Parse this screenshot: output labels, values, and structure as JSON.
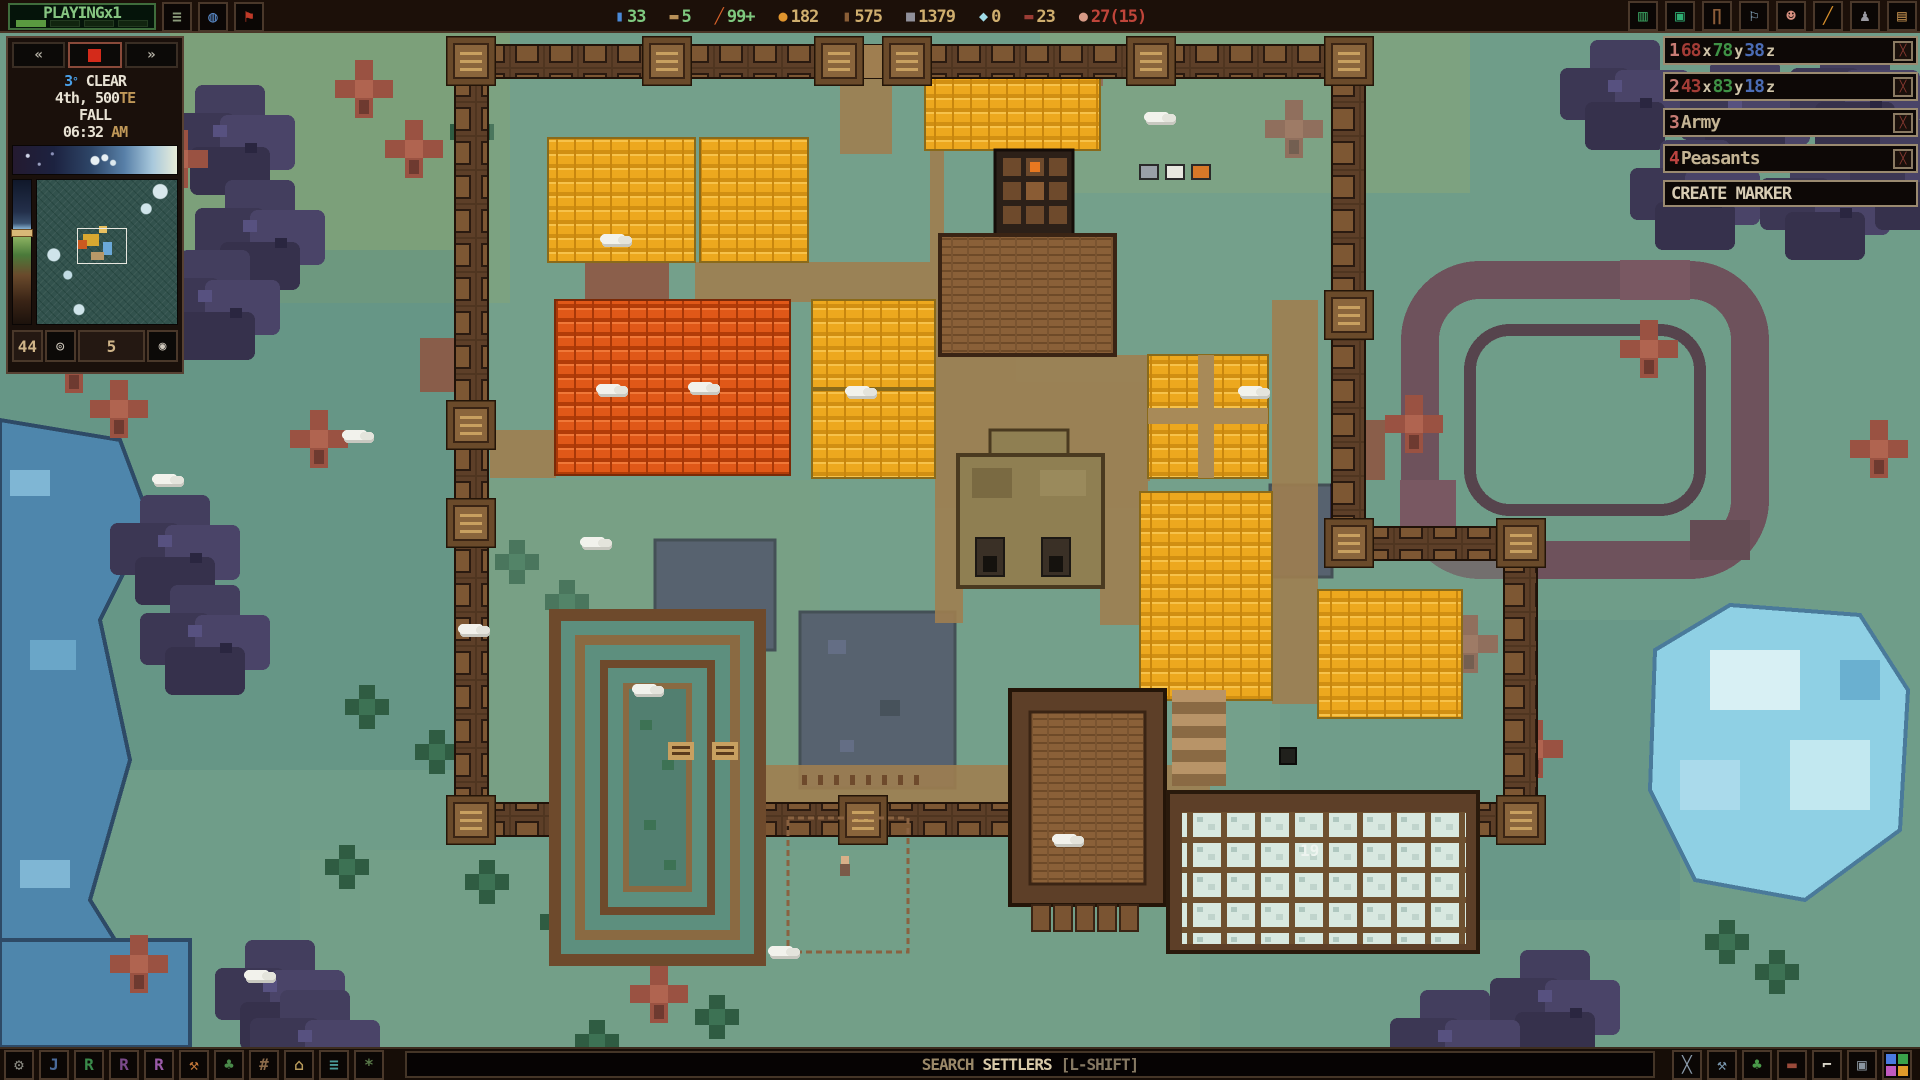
{
  "colors": {
    "accent_green": "#7fc97f",
    "accent_tan": "#cfae6e",
    "accent_red": "#c0453a",
    "ui_border": "#574133",
    "panel_bg": "#1a100b",
    "marker_border": "#9a8a70"
  },
  "top_bar": {
    "play_state": "PLAYINGx1",
    "progress_segments_total": 4,
    "progress_segments_filled": 1,
    "left_icons": [
      {
        "name": "menu-list-icon",
        "glyph": "≡",
        "color": "#8a9a7a"
      },
      {
        "name": "world-icon",
        "glyph": "◍",
        "color": "#5a8ac8"
      },
      {
        "name": "flag-icon",
        "glyph": "⚑",
        "color": "#c03a28"
      }
    ],
    "resources": [
      {
        "name": "water",
        "glyph": "▮",
        "icon_color": "#4a8ad8",
        "value": "33",
        "value_color": "#7fc97f"
      },
      {
        "name": "rations",
        "glyph": "▬",
        "icon_color": "#b89058",
        "value": "5",
        "value_color": "#7fc97f"
      },
      {
        "name": "vegetables",
        "glyph": "╱",
        "icon_color": "#d8622a",
        "value": "99+",
        "value_color": "#7fc97f"
      },
      {
        "name": "fruit",
        "glyph": "●",
        "icon_color": "#e0952e",
        "value": "182",
        "value_color": "#cfae6e"
      },
      {
        "name": "wood",
        "glyph": "▮",
        "icon_color": "#8a5e36",
        "value": "575",
        "value_color": "#cfae6e"
      },
      {
        "name": "stone",
        "glyph": "■",
        "icon_color": "#90909a",
        "value": "1379",
        "value_color": "#cfae6e"
      },
      {
        "name": "ice",
        "glyph": "◆",
        "icon_color": "#a0dce8",
        "value": "0",
        "value_color": "#cfae6e"
      },
      {
        "name": "meat",
        "glyph": "▬",
        "icon_color": "#9a3c34",
        "value": "23",
        "value_color": "#cfae6e"
      },
      {
        "name": "settlers",
        "glyph": "●",
        "icon_color": "#d89a86",
        "value": "27(15)",
        "value_color": "#c0453a"
      }
    ],
    "right_icons": [
      {
        "name": "overview-icon",
        "glyph": "▥",
        "color": "#3aa060"
      },
      {
        "name": "gem-icon",
        "glyph": "▣",
        "color": "#2fae72"
      },
      {
        "name": "anvil-icon",
        "glyph": "∏",
        "color": "#8a5c38"
      },
      {
        "name": "scroll-icon",
        "glyph": "⚐",
        "color": "#9ec4e0"
      },
      {
        "name": "face-icon",
        "glyph": "☻",
        "color": "#d89080"
      },
      {
        "name": "wand-icon",
        "glyph": "╱",
        "color": "#d8902c"
      },
      {
        "name": "armor-icon",
        "glyph": "♟",
        "color": "#9a9aa2"
      },
      {
        "name": "ledger-icon",
        "glyph": "▤",
        "color": "#b8884a"
      }
    ]
  },
  "left_panel": {
    "speed": {
      "slower": "«",
      "faster": "»"
    },
    "weather": {
      "temp": "3",
      "temp_unit": "°",
      "condition": "CLEAR",
      "date": "4th, 500",
      "date_suffix": "TE",
      "season": "FALL",
      "time": "06:32",
      "meridiem": "AM"
    },
    "counters": {
      "left_value": "44",
      "right_value": "5",
      "zoom_out_glyph": "◎",
      "zoom_in_glyph": "◉"
    }
  },
  "markers": {
    "remove_glyph": "╳",
    "rows": [
      {
        "num": "1",
        "xv": "68",
        "xl": "x",
        "yv": "78",
        "yl": "y",
        "zv": "38",
        "zl": "z"
      },
      {
        "num": "2",
        "xv": "43",
        "xl": "x",
        "yv": "83",
        "yl": "y",
        "zv": "18",
        "zl": "z"
      },
      {
        "num": "3",
        "label": "Army"
      },
      {
        "num": "4",
        "label": "Peasants"
      }
    ],
    "create_label": "CREATE MARKER"
  },
  "bottom_bar": {
    "left_icons": [
      {
        "name": "settings-gear-icon",
        "glyph": "⚙",
        "color": "#8a8a82"
      },
      {
        "name": "jobs-icon",
        "glyph": "J",
        "color": "#4a6a9a"
      },
      {
        "name": "rooms-icon",
        "glyph": "R",
        "color": "#3a8a4a"
      },
      {
        "name": "zones-icon",
        "glyph": "R",
        "color": "#7a4a8a"
      },
      {
        "name": "areas-icon",
        "glyph": "R",
        "color": "#9a5aa8"
      },
      {
        "name": "dig-tool-icon",
        "glyph": "⚒",
        "color": "#c87a3a"
      },
      {
        "name": "plants-icon",
        "glyph": "♣",
        "color": "#4a8a4a"
      },
      {
        "name": "floors-grid-icon",
        "glyph": "#",
        "color": "#8a6a4a"
      },
      {
        "name": "structures-icon",
        "glyph": "⌂",
        "color": "#b89a5a"
      },
      {
        "name": "list-panel-icon",
        "glyph": "≡",
        "color": "#4a9a9a"
      },
      {
        "name": "effects-icon",
        "glyph": "*",
        "color": "#5a7a4a"
      }
    ],
    "search": {
      "word1": "SEARCH",
      "word2": "SETTLERS",
      "word3": "[L-SHIFT]"
    },
    "right_icons": [
      {
        "name": "cancel-cross-icon",
        "glyph": "╳",
        "color": "#8a9aaa"
      },
      {
        "name": "build-hammer-icon",
        "glyph": "⚒",
        "color": "#7a98b0"
      },
      {
        "name": "clover-icon",
        "glyph": "♣",
        "color": "#4a9a4a"
      },
      {
        "name": "bed-icon",
        "glyph": "▬",
        "color": "#9a4a3a"
      },
      {
        "name": "frame-corner-icon",
        "glyph": "⌐",
        "color": "#d8d4c8"
      },
      {
        "name": "lock-icon",
        "glyph": "▣",
        "color": "#8a95a0"
      },
      {
        "name": "palette-grid-icon",
        "colors": [
          "#4a7ae0",
          "#3aa04a",
          "#c05ac0",
          "#e09a2a"
        ]
      }
    ]
  },
  "map": {
    "storage_count": "19"
  }
}
